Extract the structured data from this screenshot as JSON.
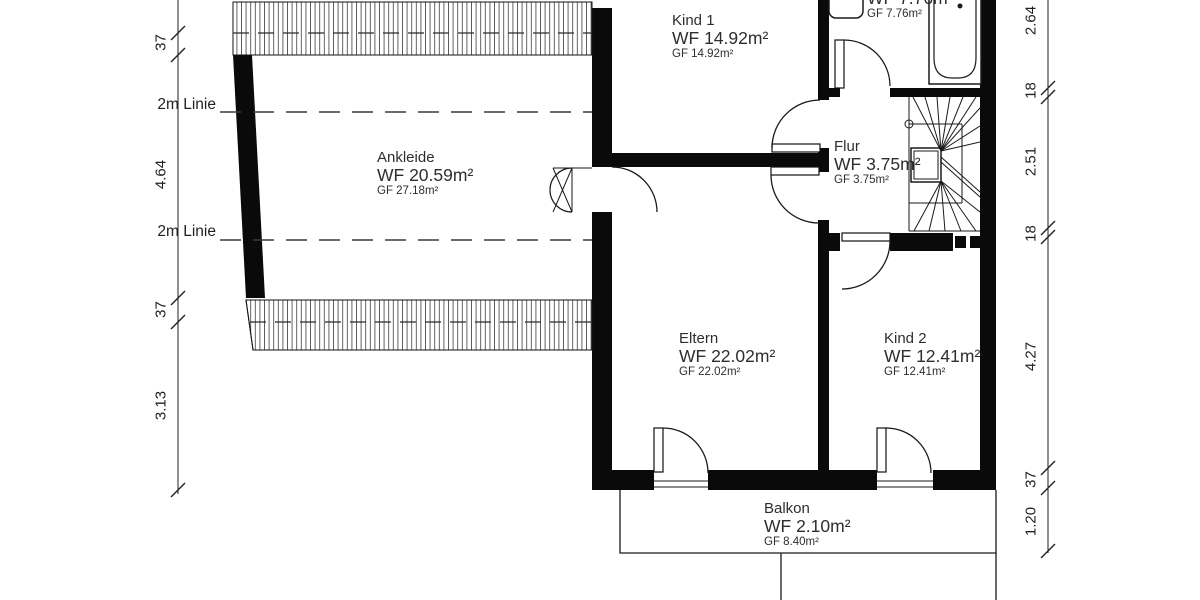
{
  "rooms": {
    "kind1": {
      "name": "Kind 1",
      "wf": "WF 14.92m²",
      "gf": "GF 14.92m²"
    },
    "bad": {
      "wf": "WF 7.76m²",
      "gf": "GF 7.76m²"
    },
    "ankleide": {
      "name": "Ankleide",
      "wf": "WF 20.59m²",
      "gf": "GF 27.18m²"
    },
    "flur": {
      "name": "Flur",
      "wf": "WF 3.75m²",
      "gf": "GF 3.75m²"
    },
    "eltern": {
      "name": "Eltern",
      "wf": "WF 22.02m²",
      "gf": "GF 22.02m²"
    },
    "kind2": {
      "name": "Kind 2",
      "wf": "WF 12.41m²",
      "gf": "GF 12.41m²"
    },
    "balkon": {
      "name": "Balkon",
      "wf": "WF 2.10m²",
      "gf": "GF 8.40m²"
    }
  },
  "dimensions": {
    "left": {
      "d1": "37",
      "d2": "4.64",
      "d3": "37",
      "d4": "3.13",
      "line1": "2m Linie",
      "line2": "2m Linie"
    },
    "right": {
      "d1": "2.64",
      "d2": "18",
      "d3": "2.51",
      "d4": "18",
      "d5": "4.27",
      "d6": "37",
      "d7": "1.20"
    }
  },
  "colors": {
    "wall": "#0a0a0a",
    "line": "#1a1a1a",
    "text": "#2e2e2e",
    "background": "#ffffff"
  }
}
